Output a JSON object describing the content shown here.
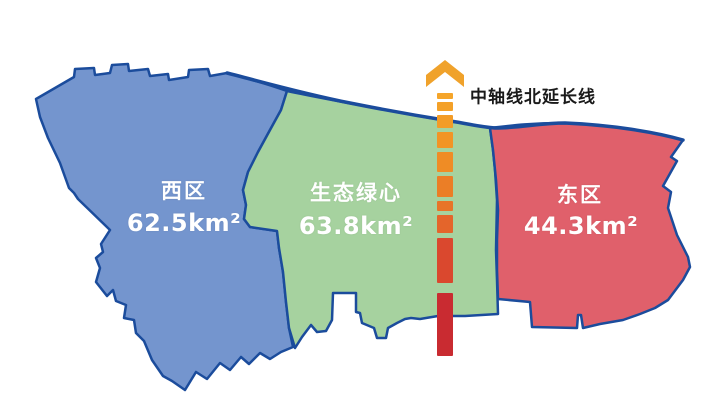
{
  "figure_background": "#ffffff",
  "outline_color": "#1b4c9c",
  "regions": [
    {
      "id": "west",
      "name": "西区",
      "area": "62.5km²",
      "fill": "#7495ce"
    },
    {
      "id": "green-heart",
      "name": "生态绿心",
      "area": "63.8km²",
      "fill": "#a6d29f"
    },
    {
      "id": "east",
      "name": "东区",
      "area": "44.3km²",
      "fill": "#e0606b"
    }
  ],
  "axis": {
    "label": "中轴线北延长线",
    "label_color": "#1a1a1a",
    "arrow_color": "#f0a22b",
    "x": 437,
    "width": 16,
    "dashes": [
      {
        "y": 93,
        "h": 6,
        "color": "#f5a52a"
      },
      {
        "y": 102,
        "h": 9,
        "color": "#f4a128"
      },
      {
        "y": 115,
        "h": 13,
        "color": "#f39c27"
      },
      {
        "y": 132,
        "h": 16,
        "color": "#f29425"
      },
      {
        "y": 152,
        "h": 20,
        "color": "#ef8c25"
      },
      {
        "y": 176,
        "h": 21,
        "color": "#eb7e26"
      },
      {
        "y": 201,
        "h": 10,
        "color": "#e87428"
      },
      {
        "y": 215,
        "h": 18,
        "color": "#e4652b"
      },
      {
        "y": 238,
        "h": 45,
        "color": "#da482e"
      },
      {
        "y": 293,
        "h": 63,
        "color": "#c92b31"
      }
    ]
  }
}
